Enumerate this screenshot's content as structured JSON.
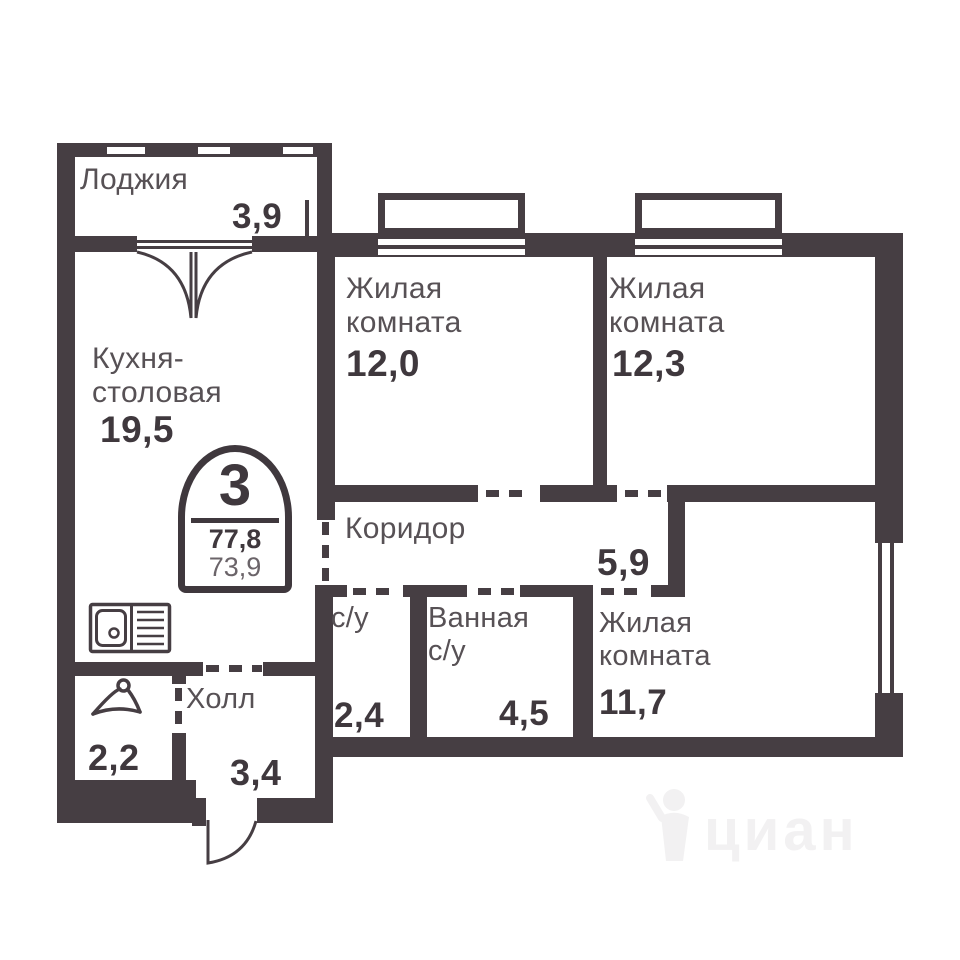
{
  "stamp": {
    "rooms_count": "3",
    "total_area": "77,8",
    "living_area": "73,9"
  },
  "rooms": {
    "loggia": {
      "label": "Лоджия",
      "area": "3,9"
    },
    "kitchen": {
      "label": "Кухня-столовая",
      "area": "19,5"
    },
    "living_room_1": {
      "label": "Жилая комната",
      "area": "12,0"
    },
    "living_room_2": {
      "label": "Жилая комната",
      "area": "12,3"
    },
    "corridor": {
      "label": "Коридор",
      "area": "5,9"
    },
    "wc": {
      "label": "с/у",
      "area": "2,4"
    },
    "bathroom": {
      "label": "Ванная с/у",
      "area": "4,5"
    },
    "living_room_3": {
      "label": "Жилая комната",
      "area": "11,7"
    },
    "hall": {
      "label": "Холл",
      "area": "3,4"
    },
    "wardrobe": {
      "area": "2,2"
    }
  },
  "watermark": {
    "text": "циан"
  },
  "colors": {
    "wall": "#463e43",
    "label": "#575155",
    "number": "#3f383d",
    "watermark": "#f2f1f2"
  }
}
